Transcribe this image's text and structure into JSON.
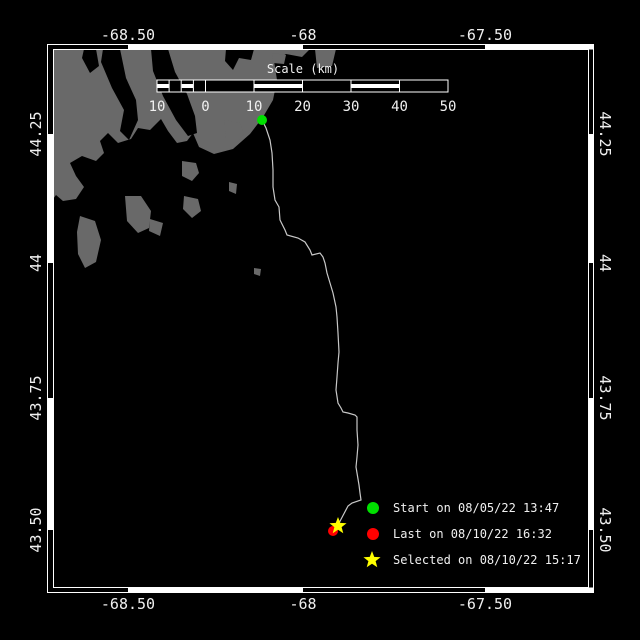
{
  "window": {
    "description": "Black track-plot map with box-style axes, scale bar and legend"
  },
  "colors": {
    "background": "#000000",
    "land": "#696969",
    "water": "#000000",
    "frame": "#ffffff",
    "text": "#f0f0f0",
    "track": "#c8c8c8",
    "start": "#00e000",
    "last": "#ff0000",
    "selected": "#ffff00"
  },
  "axes": {
    "top": {
      "labels": [
        "-68.50",
        "-68",
        "-67.50"
      ]
    },
    "bottom": {
      "labels": [
        "-68.50",
        "-68",
        "-67.50"
      ]
    },
    "left": {
      "labels": [
        "44.25",
        "44",
        "43.75",
        "43.50"
      ]
    },
    "right": {
      "labels": [
        "44.25",
        "44",
        "43.75",
        "43.50"
      ]
    }
  },
  "scale_bar": {
    "title": "Scale (km)",
    "tick_labels": [
      "10",
      "0",
      "10",
      "20",
      "30",
      "40",
      "50"
    ]
  },
  "legend": {
    "items": [
      {
        "marker": "start-dot",
        "color": "#00e000",
        "label": "Start on 08/05/22 13:47"
      },
      {
        "marker": "last-dot",
        "color": "#ff0000",
        "label": "Last on 08/10/22 16:32"
      },
      {
        "marker": "selected-star",
        "color": "#ffff00",
        "label": "Selected on 08/10/22 15:17"
      }
    ]
  },
  "map": {
    "track": "262,120 266,128 270,140 272,153 273,170 273,187 275,200 279,207 280,220 285,230 287,235 298,238 305,242 310,250 312,255 320,253 323,257 325,263 327,273 330,283 333,293 336,307 337,317 338,333 339,352 338,363 337,377 336,390 338,403 341,408 343,412 348,413 355,415 357,417 357,430 358,445 357,457 356,467 357,473 359,485 360,493 361,500 352,503 348,506 338,525",
    "land_main": "M53,49 L310,49 L302,57 L286,54 L274,61 L277,80 L273,100 L263,117 L250,134 L233,149 L214,154 L199,147 L193,133 L187,141 L177,143 L168,131 L161,119 L150,130 L138,128 L131,139 L118,143 L108,133 L100,141 L104,153 L96,161 L82,156 L70,163 L76,176 L84,187 L76,199 L63,201 L56,195 L53,199 Z",
    "water_cut_1": "M103,49 L120,49 L126,78 L136,100 L138,120 L129,140 L120,131 L124,110 L112,88 L101,62 Z",
    "water_cut_2": "M151,49 L168,49 L175,72 L187,94 L195,116 L197,133 L188,136 L176,120 L163,96 L153,71 Z",
    "water_cut_3": "M84,49 L96,49 L99,66 L90,73 L82,58 Z",
    "water_cut_4": "M226,49 L254,49 L251,60 L239,58 L233,70 L225,61 Z",
    "islands": "M80,216 L95,221 L101,240 L96,262 L85,268 L78,254 L77,232 Z M125,196 L141,196 L151,211 L149,228 L138,233 L127,221 Z M150,219 L163,223 L160,236 L149,231 Z M182,161 L196,163 L199,173 L192,181 L182,176 Z M184,196 L198,199 L201,211 L192,218 L183,209 Z M224,120 L240,123 L244,134 L236,143 L226,138 Z M229,182 L237,184 L236,194 L229,191 Z M272,53 L286,55 L284,64 L273,63 Z M315,49 L336,49 L332,66 L317,68 Z M254,268 L261,269 L260,276 L254,274 Z",
    "star_shape": "0,-9 2.23,-3.07 8.56,-2.78 3.61,1.17 5.29,7.28 0,3.8 -5.29,7.28 -3.61,1.17 -8.56,-2.78 -2.23,-3.07"
  }
}
